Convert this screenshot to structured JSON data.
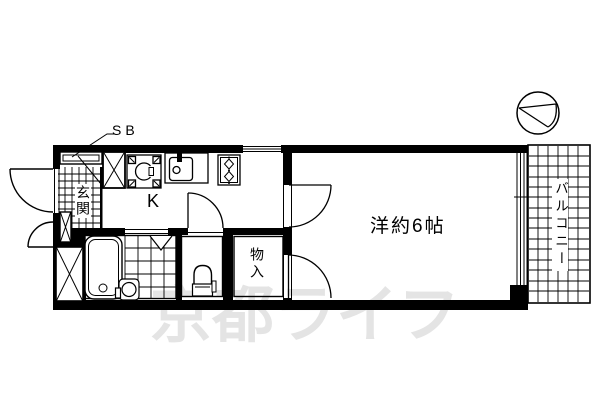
{
  "plan": {
    "labels": {
      "shoe_box": "SB",
      "kitchen": "K",
      "entrance": "玄関",
      "main_room": "洋約6帖",
      "closet": "物入",
      "balcony": "バルコニー"
    },
    "watermark": "京都ライフ",
    "colors": {
      "line": "#000000",
      "background": "#ffffff",
      "watermark": "#e4e4e4"
    }
  }
}
